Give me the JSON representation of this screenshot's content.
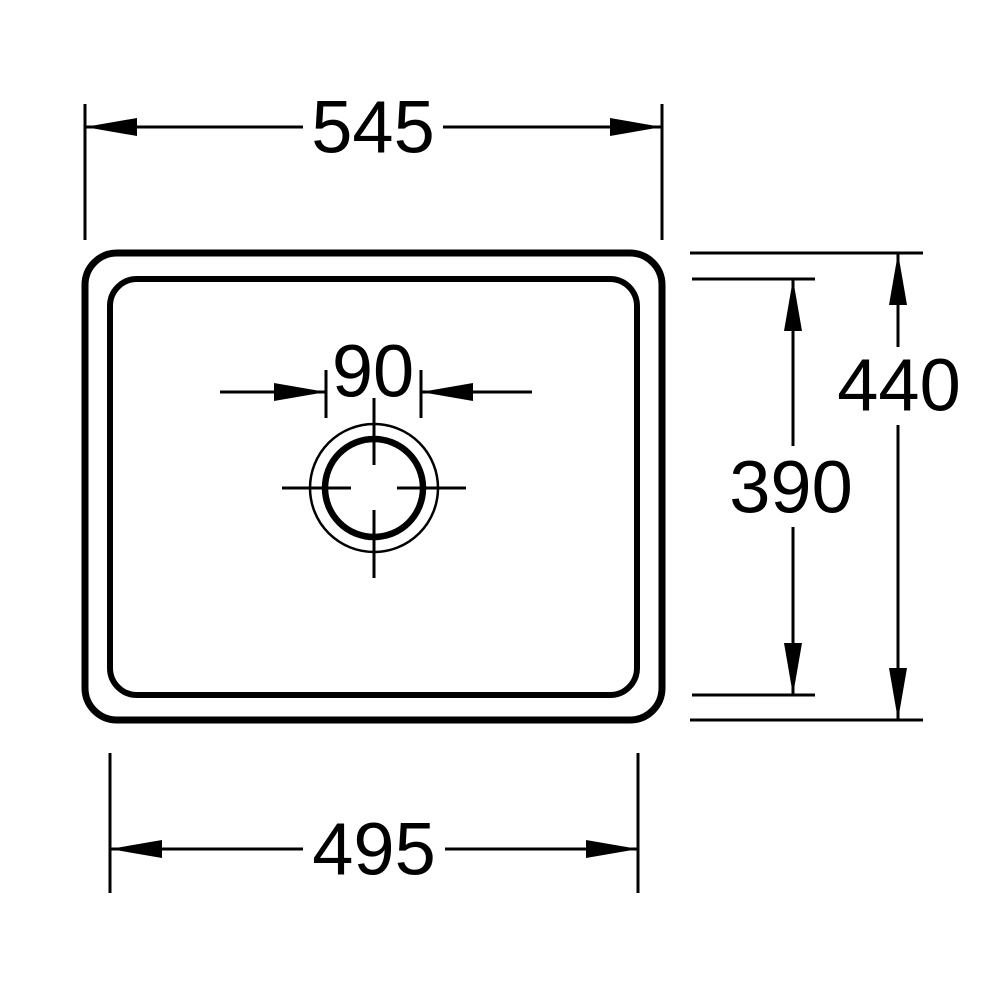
{
  "page": {
    "background_color": "#ffffff",
    "line_color": "#000000"
  },
  "drawing": {
    "view": "sink-top-view-dimension-drawing",
    "dimensions": {
      "top_width": "545",
      "bottom_width": "495",
      "outer_height": "440",
      "inner_height": "390",
      "drain_diameter": "90"
    }
  }
}
